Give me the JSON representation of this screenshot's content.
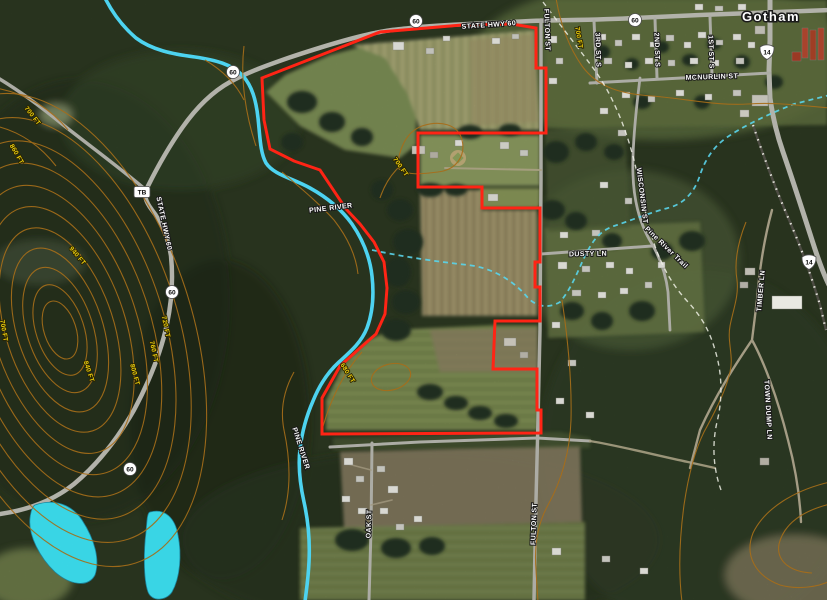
{
  "map": {
    "town_name": "Gotham",
    "labels": {
      "state_hwy_60_top": "STATE HWY 60",
      "state_hwy_60_west": "STATE HWY 60",
      "fulton_st_north": "FULTON ST",
      "fulton_st_south": "FULTON ST",
      "oak_st": "OAK ST",
      "dusty_ln": "DUSTY LN",
      "wisconsin_st": "WISCONSIN ST",
      "mcnurlin_st": "MCNURLIN ST",
      "first_st_s": "1ST ST S",
      "second_st_s": "2ND ST S",
      "third_st_s": "3RD ST S",
      "timber_ln": "TIMBER LN",
      "town_dump_ln": "TOWN DUMP LN",
      "pine_river_north": "PINE RIVER",
      "pine_river_south": "PINE RIVER",
      "pine_river_trail": "Pine River Trail"
    },
    "contour_labels": [
      "700 FT",
      "860 FT",
      "940 FT",
      "720 FT",
      "760 FT",
      "800 FT",
      "840 FT",
      "700 FT",
      "700 FT",
      "700 FT",
      "680 FT"
    ],
    "shields": {
      "state_60": "60",
      "us_14": "14",
      "county_tb": "TB"
    },
    "colors": {
      "parcel_boundary": "#ff2817",
      "river": "#55d7f2",
      "stream": "#63d9ef",
      "pond": "#3fd9e8",
      "contour_line": "#b0791c",
      "contour_label": "#f2d60e",
      "street_label": "#ffffff"
    }
  }
}
